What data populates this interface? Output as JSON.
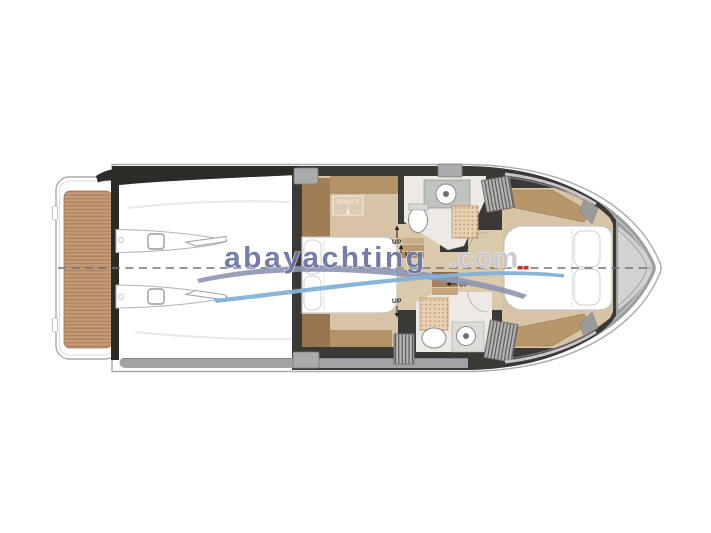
{
  "watermark": {
    "brand": "abayachting",
    "suffix": ".com"
  },
  "plan_labels": {
    "beauty": "BEAUTY",
    "up": "UP"
  },
  "colors": {
    "brand-blue": "#6a73a2",
    "brand-suffix": "#c7cad2",
    "swoosh-gray": "#8d95b0",
    "swoosh-blue": "#82b2d8",
    "hull-white": "#ffffff",
    "hull-line": "#a8aaac",
    "deck-gray": "#9d9d9d",
    "charcoal": "#3a3936",
    "black-trim": "#2c2b28",
    "teak": "#c49a77",
    "teak-stripe": "#a17a55",
    "floor-tan": "#d7c4a6",
    "floor-light": "#dbc9ab",
    "bath-floor": "#edeae5",
    "wood-light": "#b29266",
    "wood-mid": "#9f7e55",
    "wood-dark": "#96754f",
    "mat": "#e6d1b5",
    "mat-dot": "#b98e63",
    "fixture-line": "#8a8a8a",
    "block-gray": "#ababab",
    "red-mark": "#d23127",
    "centerline": "#717376",
    "label-dark": "#1f1f1f"
  }
}
